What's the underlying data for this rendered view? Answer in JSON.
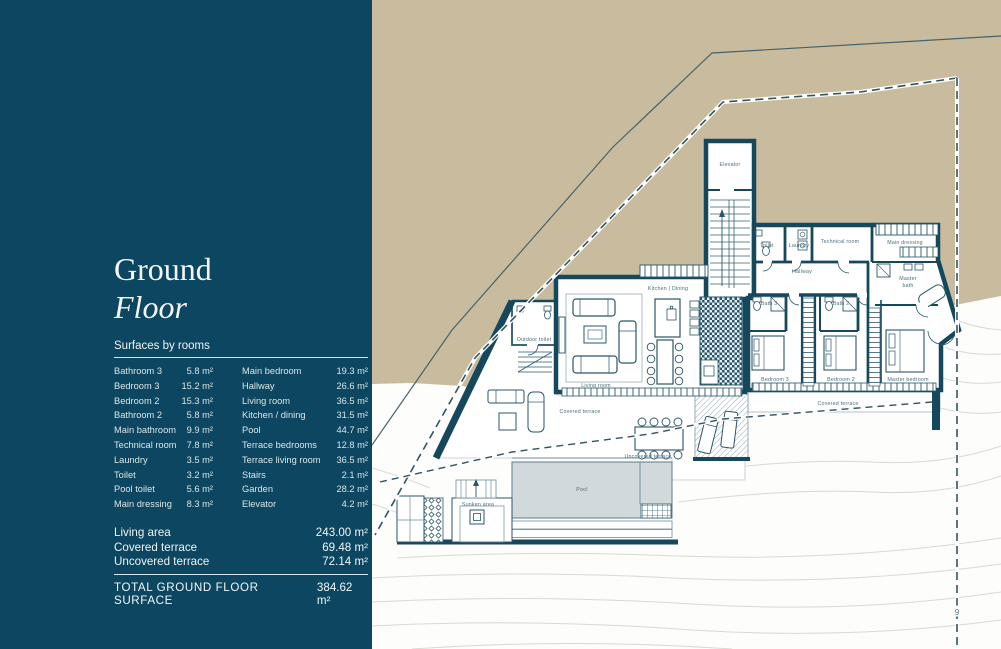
{
  "panel": {
    "title_line1": "Ground",
    "title_line2": "Floor",
    "section_label": "Surfaces by rooms",
    "rooms_col1": [
      {
        "name": "Bathroom 3",
        "area": "5.8 m²"
      },
      {
        "name": "Bedroom 3",
        "area": "15.2 m²"
      },
      {
        "name": "Bedroom 2",
        "area": "15.3 m²"
      },
      {
        "name": "Bathroom 2",
        "area": "5.8 m²"
      },
      {
        "name": "Main bathroom",
        "area": "9.9 m²"
      },
      {
        "name": "Technical room",
        "area": "7.8 m²"
      },
      {
        "name": "Laundry",
        "area": "3.5 m²"
      },
      {
        "name": "Toilet",
        "area": "3.2 m²"
      },
      {
        "name": "Pool toilet",
        "area": "5.6 m²"
      },
      {
        "name": "Main dressing",
        "area": "8.3 m²"
      }
    ],
    "rooms_col2": [
      {
        "name": "Main bedroom",
        "area": "19.3 m²"
      },
      {
        "name": "Hallway",
        "area": "26.6 m²"
      },
      {
        "name": "Living room",
        "area": "36.5 m²"
      },
      {
        "name": "Kitchen / dining",
        "area": "31.5 m²"
      },
      {
        "name": "Pool",
        "area": "44.7 m²"
      },
      {
        "name": "Terrace bedrooms",
        "area": "12.8 m²"
      },
      {
        "name": "Terrace living room",
        "area": "36.5 m²"
      },
      {
        "name": "Stairs",
        "area": "2.1 m²"
      },
      {
        "name": "Garden",
        "area": "28.2 m²"
      },
      {
        "name": "Elevator",
        "area": "4.2 m²"
      }
    ],
    "summary": [
      {
        "label": "Living area",
        "value": "243.00 m²"
      },
      {
        "label": "Covered terrace",
        "value": "69.48 m²"
      },
      {
        "label": "Uncovered terrace",
        "value": "72.14 m²"
      }
    ],
    "total": {
      "label": "TOTAL GROUND FLOOR SURFACE",
      "value": "384.62 m²"
    }
  },
  "plan": {
    "labels": {
      "elevator": "Elevator",
      "toilet": "Toilet",
      "laundry": "Laundry",
      "technical_room": "Technical room",
      "main_dressing": "Main dressing",
      "hallway": "Hallway",
      "bath3": "Bath 3",
      "bath2": "Bath 2",
      "master_bath_1": "Master",
      "master_bath_2": "bath",
      "bedroom3": "Bedroom 3",
      "bedroom2": "Bedroom 2",
      "master_bedroom": "Master bedroom",
      "covered_terrace_right": "Covered terrace",
      "covered_terrace_left": "Covered terrace",
      "kitchen_dining": "Kitchen | Dining",
      "living_room": "Living room",
      "outdoor_toilet": "Outdoor toilet",
      "uncovered_terrace": "Uncovered terrace",
      "pool": "Pool",
      "sunken_area": "Sunken area",
      "boundary_marker": "9"
    },
    "colors": {
      "panel_background": "#0d4660",
      "terrain_sand": "#c9bc9e",
      "wall_teal": "#16485d",
      "pool_water": "#d2d9dc",
      "contour_grey": "#d8dad3"
    }
  }
}
